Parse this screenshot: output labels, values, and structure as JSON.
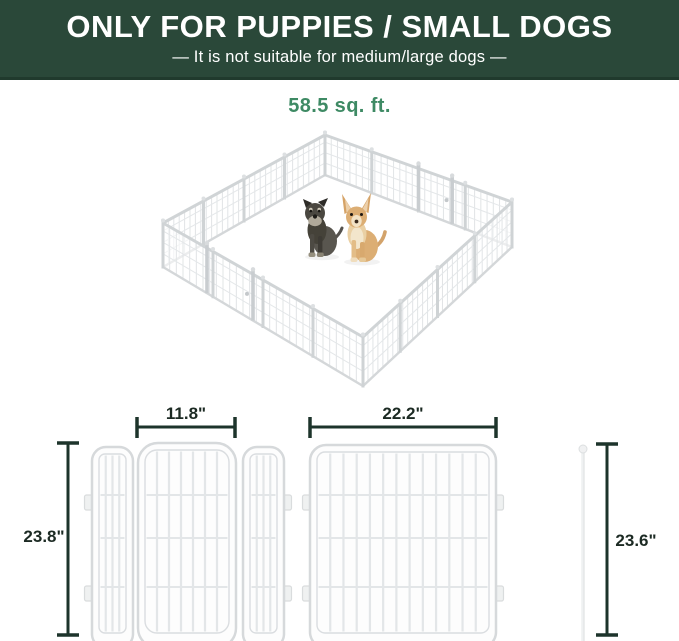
{
  "banner": {
    "title": "ONLY FOR PUPPIES / SMALL DOGS",
    "subtitle": "— It is not suitable for medium/large dogs —",
    "bg_color": "#2a4839",
    "text_color": "#ffffff"
  },
  "area": {
    "label": "58.5 sq. ft.",
    "color": "#3e8a64"
  },
  "illustration": {
    "name": "white wire playpen, isometric view, 16 panels with two doors",
    "dogs": [
      "schnauzer-puppy",
      "chihuahua"
    ]
  },
  "diagram": {
    "door_section_width": "11.8\"",
    "door_section_height": "23.8\"",
    "panel_width": "22.2\"",
    "pole_height": "23.6\"",
    "line_color": "#1d342b"
  }
}
